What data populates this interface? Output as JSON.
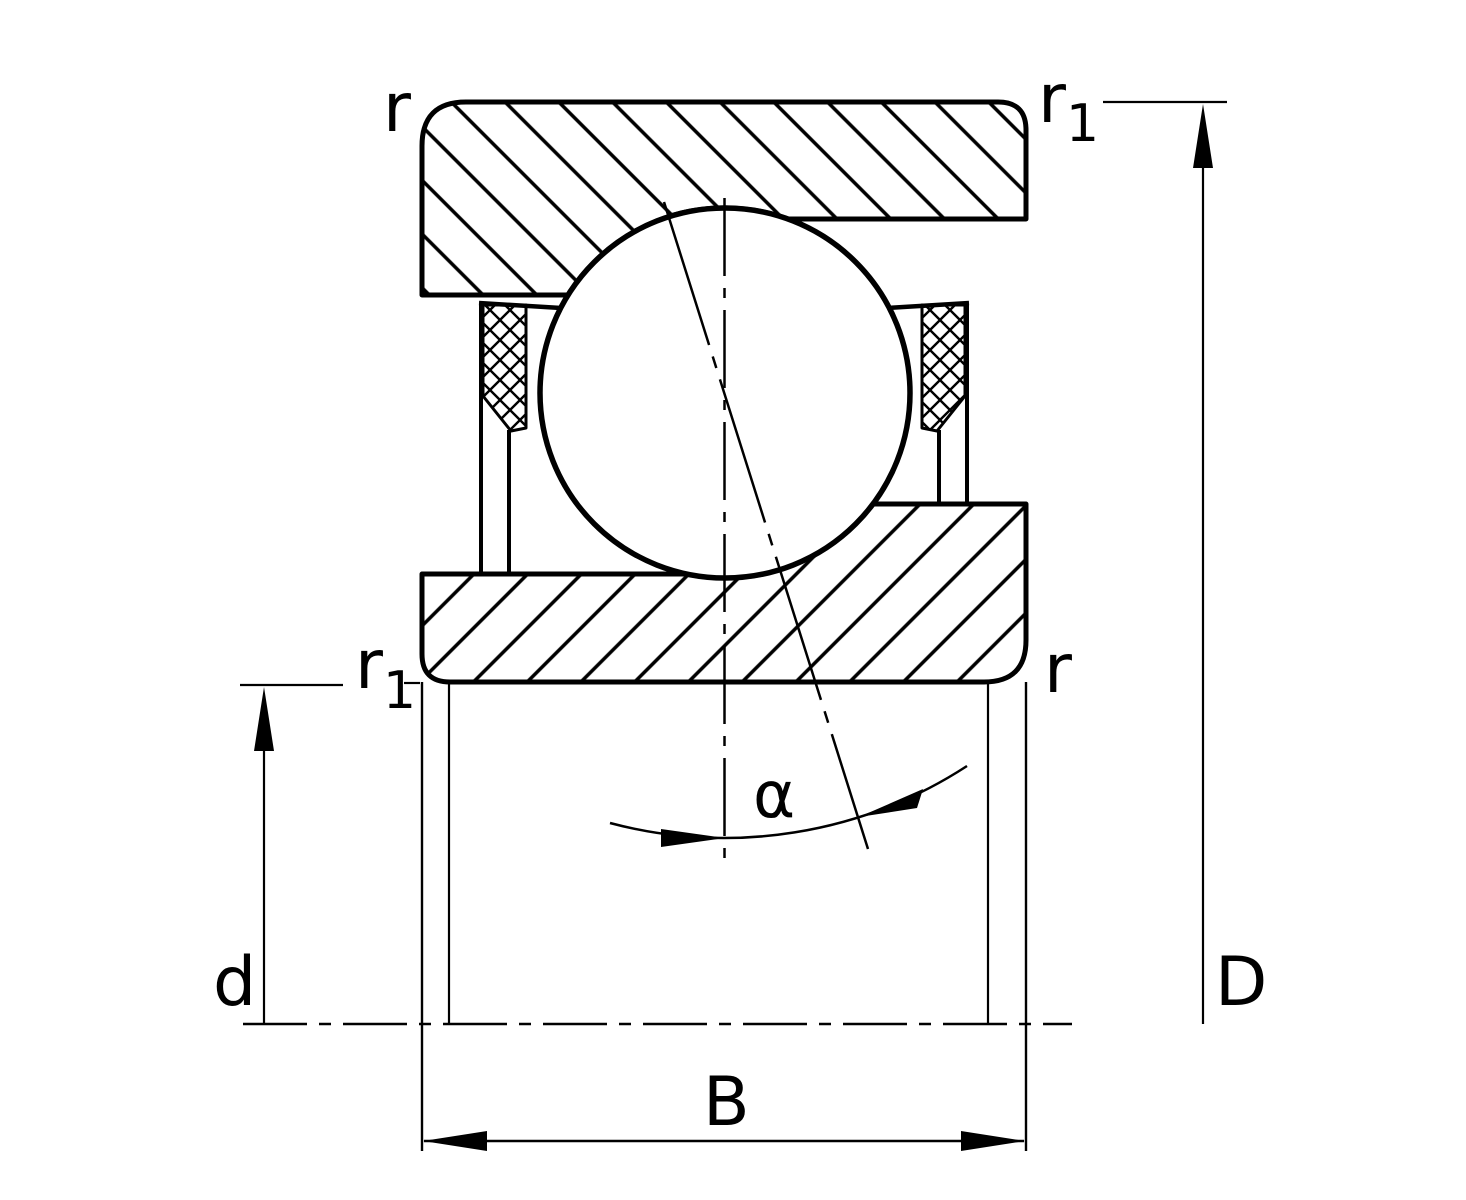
{
  "diagram": {
    "description": "Angular contact ball bearing cross-section drawing",
    "labels": {
      "chamfer_outer_left": "r",
      "chamfer_outer_right": {
        "main": "r",
        "sub": "1"
      },
      "chamfer_inner_left": {
        "main": "r",
        "sub": "1"
      },
      "chamfer_inner_right": "r",
      "bore_diameter": "d",
      "outside_diameter": "D",
      "width": "B",
      "contact_angle": "α"
    },
    "colors": {
      "ink": "#000000",
      "background": "#ffffff"
    }
  }
}
